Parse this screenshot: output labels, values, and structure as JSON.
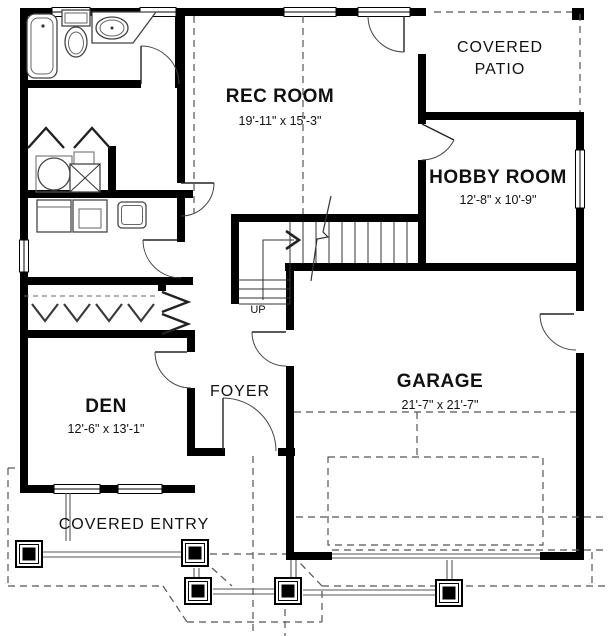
{
  "colors": {
    "wall": "#000000",
    "background": "#ffffff",
    "line_gray": "#4a4a4a",
    "dash_gray": "#555555",
    "text": "#111111"
  },
  "rooms": {
    "rec_room": {
      "name": "REC ROOM",
      "dims": "19'-11\" x 15'-3\""
    },
    "hobby_room": {
      "name": "HOBBY ROOM",
      "dims": "12'-8\" x 10'-9\""
    },
    "den": {
      "name": "DEN",
      "dims": "12'-6\" x 13'-1\""
    },
    "garage": {
      "name": "GARAGE",
      "dims": "21'-7\" x 21'-7\""
    },
    "foyer": {
      "name": "FOYER"
    }
  },
  "areas": {
    "covered_patio": {
      "line1": "COVERED",
      "line2": "PATIO"
    },
    "covered_entry": {
      "label": "COVERED ENTRY"
    }
  },
  "stairs": {
    "up_label": "UP"
  }
}
